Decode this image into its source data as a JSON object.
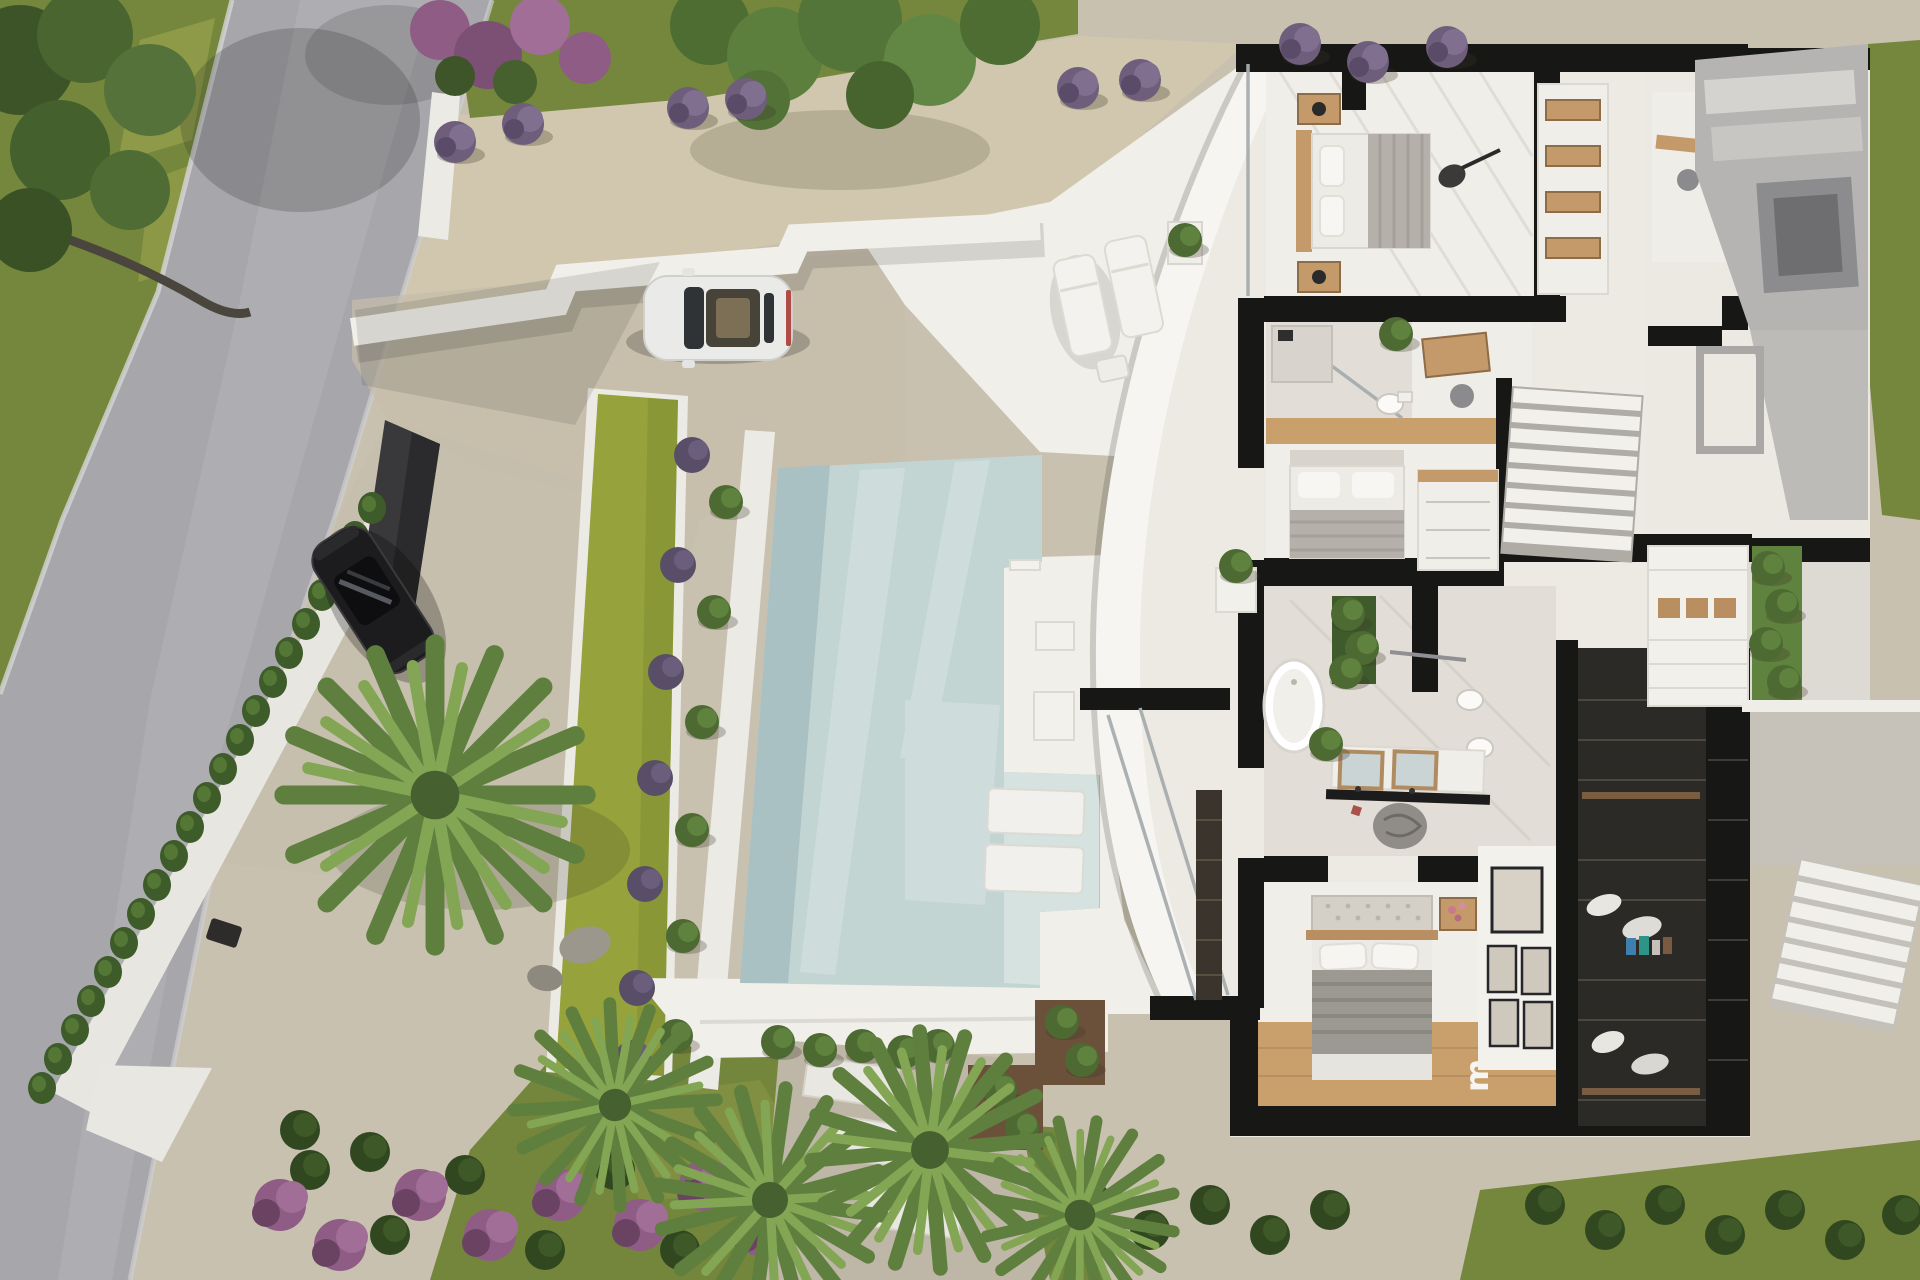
{
  "scene": {
    "type": "aerial-3d-architectural-render",
    "description": "Top-down 3D render of a modern white villa with cutaway floor plan, swimming pool, lawn strip, gravel driveway, curved facade, two parked cars, cypress hedge along a road, palm trees and lavender landscaping",
    "view": "top-down",
    "decor_letter": "m"
  },
  "colors": {
    "gravel": "#C9C1B0",
    "gravel_warm": "#D0C7AE",
    "grass": "#75873C",
    "grass_light": "#A8AE53",
    "lawn": "#96A23B",
    "road": "#A6A6AB",
    "road_light": "#B4B4B8",
    "pool": "#C2D5D3",
    "pool_deep": "#A6BDC1",
    "pool_ledge": "#D5E2DF",
    "deck": "#F1EFE9",
    "wall_white": "#F6F5F1",
    "wall_black": "#171715",
    "floor": "#EDEAE4",
    "tile": "#E2DED7",
    "wood": "#C49A6A",
    "wood_floor": "#C9A06B",
    "closet": "#2B2A26",
    "hedge": "#3E5C2A",
    "palm": "#5E7F3E",
    "palm_light": "#83A654",
    "lavender": "#6E5E7C",
    "flowers": "#8F5C85",
    "concrete": "#B5B4B3",
    "car_white": "#EAEAE8",
    "car_black": "#1C1C1E",
    "glass": "#A7ADAF"
  },
  "site": {
    "road": "asphalt road",
    "driveway": "gravel driveway",
    "gate": "dark entrance gate",
    "boundary_wall": "white boundary wall",
    "retaining_wall": "stepped retaining wall",
    "hedge_shrub_count": 21,
    "lavender_count": 9,
    "palm_count": 5,
    "stepping_stones": 3,
    "pool": "swimming pool with tanning ledge",
    "lounge_cushions": 2
  },
  "vehicles": {
    "white_car": "white sports coupe",
    "black_car": "black hatchback"
  },
  "house": {
    "style": "modern villa, cutaway top-down floor plan",
    "rooms": [
      {
        "name": "pool-terrace"
      },
      {
        "name": "bedroom-1"
      },
      {
        "name": "wardrobe"
      },
      {
        "name": "bathroom-1"
      },
      {
        "name": "study"
      },
      {
        "name": "bedroom-2"
      },
      {
        "name": "master-bathroom"
      },
      {
        "name": "master-bedroom"
      },
      {
        "name": "walk-in-closet"
      },
      {
        "name": "hallway"
      },
      {
        "name": "staircase"
      },
      {
        "name": "courtyard"
      }
    ],
    "features": {
      "sun_loungers": 2,
      "beds": 3,
      "freestanding_tub": 1,
      "vanity_mirrors": 2,
      "picture_frames": 5,
      "stair_flights": 2,
      "guitar": 1
    }
  }
}
